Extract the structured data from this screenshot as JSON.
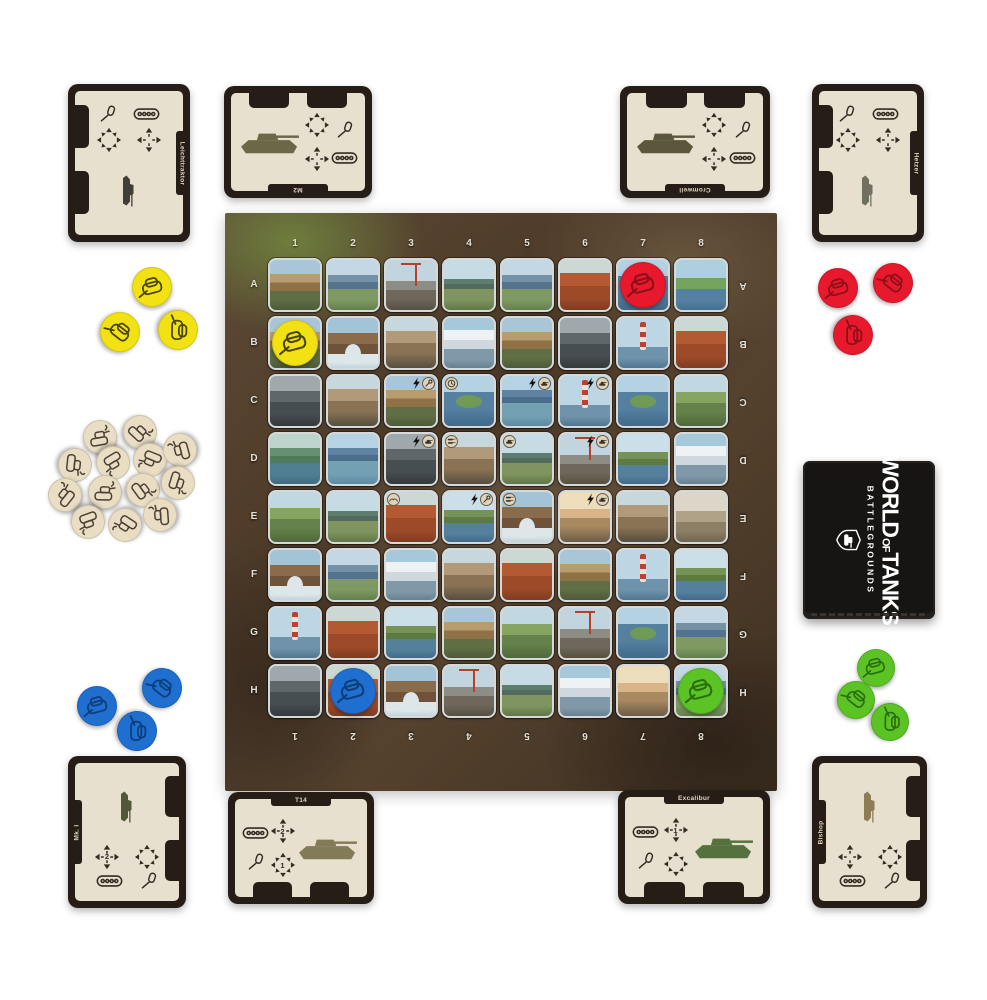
{
  "deck_box": {
    "logo_world": "WORLD",
    "logo_of": "OF",
    "logo_tanks": "TANKS",
    "subtitle": "BATTLEGROUNDS"
  },
  "board": {
    "columns": [
      "1",
      "2",
      "3",
      "4",
      "5",
      "6",
      "7",
      "8"
    ],
    "rows": [
      "A",
      "B",
      "C",
      "D",
      "E",
      "F",
      "G",
      "H"
    ],
    "tiles": [
      [
        "castle",
        "mountain",
        "crane",
        "bridge",
        "mountain",
        "poppy",
        "lake",
        "island"
      ],
      [
        "castle",
        "arch",
        "museum",
        "whiterock",
        "castle",
        "ruins",
        "lighthouse",
        "poppy"
      ],
      [
        "ruins",
        "museum",
        "castle",
        "lake",
        "mountainlake",
        "lighthouse",
        "lake",
        "village"
      ],
      [
        "river",
        "mountainlake",
        "ruins",
        "museum",
        "bridge",
        "crane",
        "cliff",
        "whiterock"
      ],
      [
        "village",
        "bridge",
        "poppy",
        "cliff",
        "arch",
        "sunrise",
        "museum",
        "dusty"
      ],
      [
        "arch",
        "mountain",
        "whiterock",
        "museum",
        "poppy",
        "castle",
        "lighthouse",
        "cliff"
      ],
      [
        "lighthouse",
        "poppy",
        "cliff",
        "castle",
        "village",
        "crane",
        "lake",
        "mountain"
      ],
      [
        "ruins",
        "poppy",
        "arch",
        "crane",
        "bridge",
        "whiterock",
        "sunrise",
        "mountain"
      ]
    ],
    "badges": {
      "C3": [
        "bolt",
        "wrench"
      ],
      "C4": [
        "clock"
      ],
      "C5": [
        "bolt",
        "tank"
      ],
      "C6": [
        "bolt",
        "tank"
      ],
      "D3": [
        "bolt",
        "tank"
      ],
      "D4": [
        "tanks"
      ],
      "D5": [
        "tank"
      ],
      "D6": [
        "bolt",
        "tank"
      ],
      "E3": [
        "eagle"
      ],
      "E4": [
        "bolt",
        "wrench"
      ],
      "E5": [
        "tanks"
      ],
      "E6": [
        "bolt",
        "tank"
      ]
    },
    "board_tokens": [
      {
        "cell": "A7",
        "color": "red"
      },
      {
        "cell": "B1",
        "color": "yellow"
      },
      {
        "cell": "H2",
        "color": "blue"
      },
      {
        "cell": "H8",
        "color": "green"
      }
    ]
  },
  "token_colors": {
    "red": "#e8192c",
    "yellow": "#f2e213",
    "blue": "#1f6fd0",
    "green": "#5cc325",
    "wreck": "#e9ddc4"
  },
  "token_colors_dark": {
    "red": "#8c0f1a",
    "yellow": "#4a4400",
    "blue": "#0d3e7a",
    "green": "#2a6e0c",
    "wreck": "#4a3f33"
  },
  "token_piles": [
    {
      "name": "yellow-tokens",
      "color": "yellow",
      "count": 3
    },
    {
      "name": "red-tokens",
      "color": "red",
      "count": 3
    },
    {
      "name": "blue-tokens",
      "color": "blue",
      "count": 3
    },
    {
      "name": "green-tokens",
      "color": "green",
      "count": 3
    },
    {
      "name": "wreck-tokens",
      "color": "wreck",
      "count": 13
    }
  ],
  "cards": [
    {
      "id": "top-left",
      "name": "Leichttraktor",
      "move": "",
      "attack": "",
      "tank_color": "#3f3f38"
    },
    {
      "id": "top-center",
      "name": "M2",
      "move": "",
      "attack": "",
      "tank_color": "#6b6747"
    },
    {
      "id": "top-right",
      "name": "Cromwell",
      "move": "",
      "attack": "",
      "tank_color": "#5a573c"
    },
    {
      "id": "right",
      "name": "Hetzer",
      "move": "",
      "attack": "",
      "tank_color": "#70705f"
    },
    {
      "id": "bottom-left",
      "name": "Mk. I",
      "move": "2",
      "attack": "",
      "tank_color": "#515738"
    },
    {
      "id": "bottom-center-left",
      "name": "T14",
      "move": "2",
      "attack": "1",
      "tank_color": "#837a57"
    },
    {
      "id": "bottom-center-right",
      "name": "Excalibur",
      "move": "1",
      "attack": "",
      "tank_color": "#55713d"
    },
    {
      "id": "bottom-right",
      "name": "Bishop",
      "move": "",
      "attack": "",
      "tank_color": "#8d7d57"
    }
  ]
}
